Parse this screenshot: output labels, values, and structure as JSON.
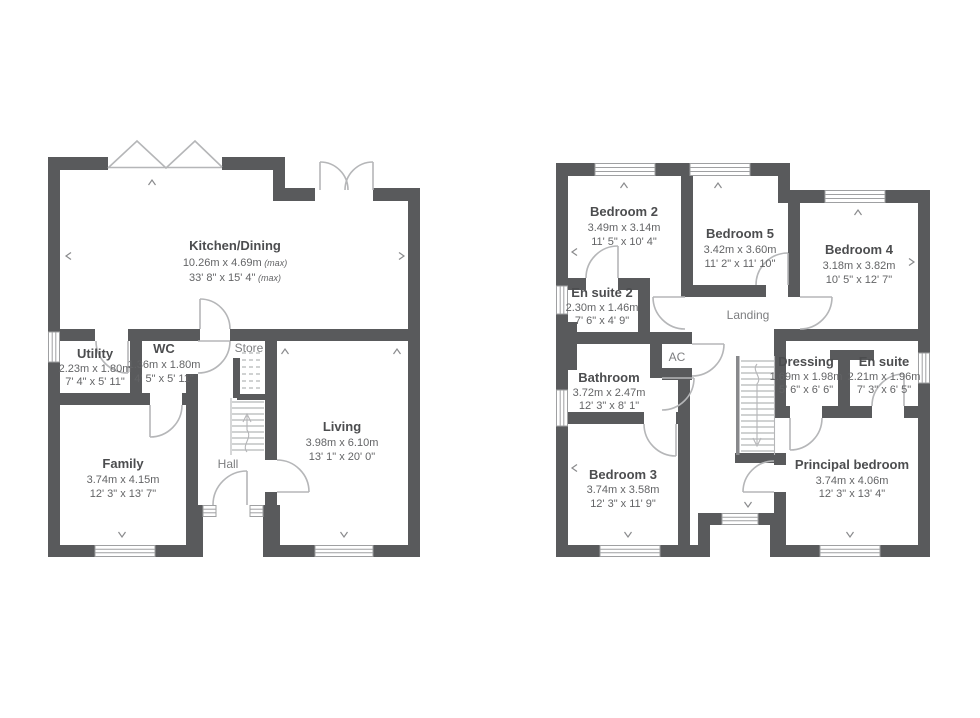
{
  "colors": {
    "wall": "#595a5c",
    "line": "#b5b6b8",
    "text_dark": "#4c4d4f",
    "text_dim": "#636466",
    "text_light": "#7d7e80"
  },
  "floors": [
    {
      "name": "ground-floor",
      "rooms": [
        {
          "id": "kitchen-dining",
          "name": "Kitchen/Dining",
          "metric": "10.26m x 4.69m",
          "metric_note": " (max)",
          "imperial": "33' 8\" x 15' 4\"",
          "imperial_note": " (max)"
        },
        {
          "id": "utility",
          "name": "Utility",
          "metric": "2.23m x 1.80m",
          "imperial": "7' 4\" x 5' 11\""
        },
        {
          "id": "wc",
          "name": "WC",
          "metric": "1.36m x 1.80m",
          "imperial": "4' 5\" x 5' 11\""
        },
        {
          "id": "family",
          "name": "Family",
          "metric": "3.74m x 4.15m",
          "imperial": "12' 3\" x 13' 7\""
        },
        {
          "id": "living",
          "name": "Living",
          "metric": "3.98m x 6.10m",
          "imperial": "13' 1\" x 20' 0\""
        },
        {
          "id": "store",
          "name": "Store"
        },
        {
          "id": "hall",
          "name": "Hall"
        }
      ]
    },
    {
      "name": "first-floor",
      "rooms": [
        {
          "id": "bedroom-2",
          "name": "Bedroom 2",
          "metric": "3.49m x 3.14m",
          "imperial": "11' 5\" x 10' 4\""
        },
        {
          "id": "bedroom-5",
          "name": "Bedroom 5",
          "metric": "3.42m x 3.60m",
          "imperial": "11' 2\" x 11' 10\""
        },
        {
          "id": "bedroom-4",
          "name": "Bedroom 4",
          "metric": "3.18m x 3.82m",
          "imperial": "10' 5\" x 12' 7\""
        },
        {
          "id": "en-suite-2",
          "name": "En suite 2",
          "metric": "2.30m x 1.46m",
          "imperial": "7' 6\" x 4' 9\""
        },
        {
          "id": "bathroom",
          "name": "Bathroom",
          "metric": "3.72m x 2.47m",
          "imperial": "12' 3\" x 8' 1\""
        },
        {
          "id": "dressing",
          "name": "Dressing",
          "metric": "1.69m x 1.98m",
          "imperial": "5' 6\" x 6' 6\""
        },
        {
          "id": "en-suite",
          "name": "En suite",
          "metric": "2.21m x 1.96m",
          "imperial": "7' 3\" x 6' 5\""
        },
        {
          "id": "bedroom-3",
          "name": "Bedroom 3",
          "metric": "3.74m x 3.58m",
          "imperial": "12' 3\" x 11' 9\""
        },
        {
          "id": "principal-bedroom",
          "name": "Principal bedroom",
          "metric": "3.74m x 4.06m",
          "imperial": "12' 3\" x 13' 4\""
        },
        {
          "id": "landing",
          "name": "Landing"
        },
        {
          "id": "ac",
          "name": "AC"
        }
      ]
    }
  ]
}
